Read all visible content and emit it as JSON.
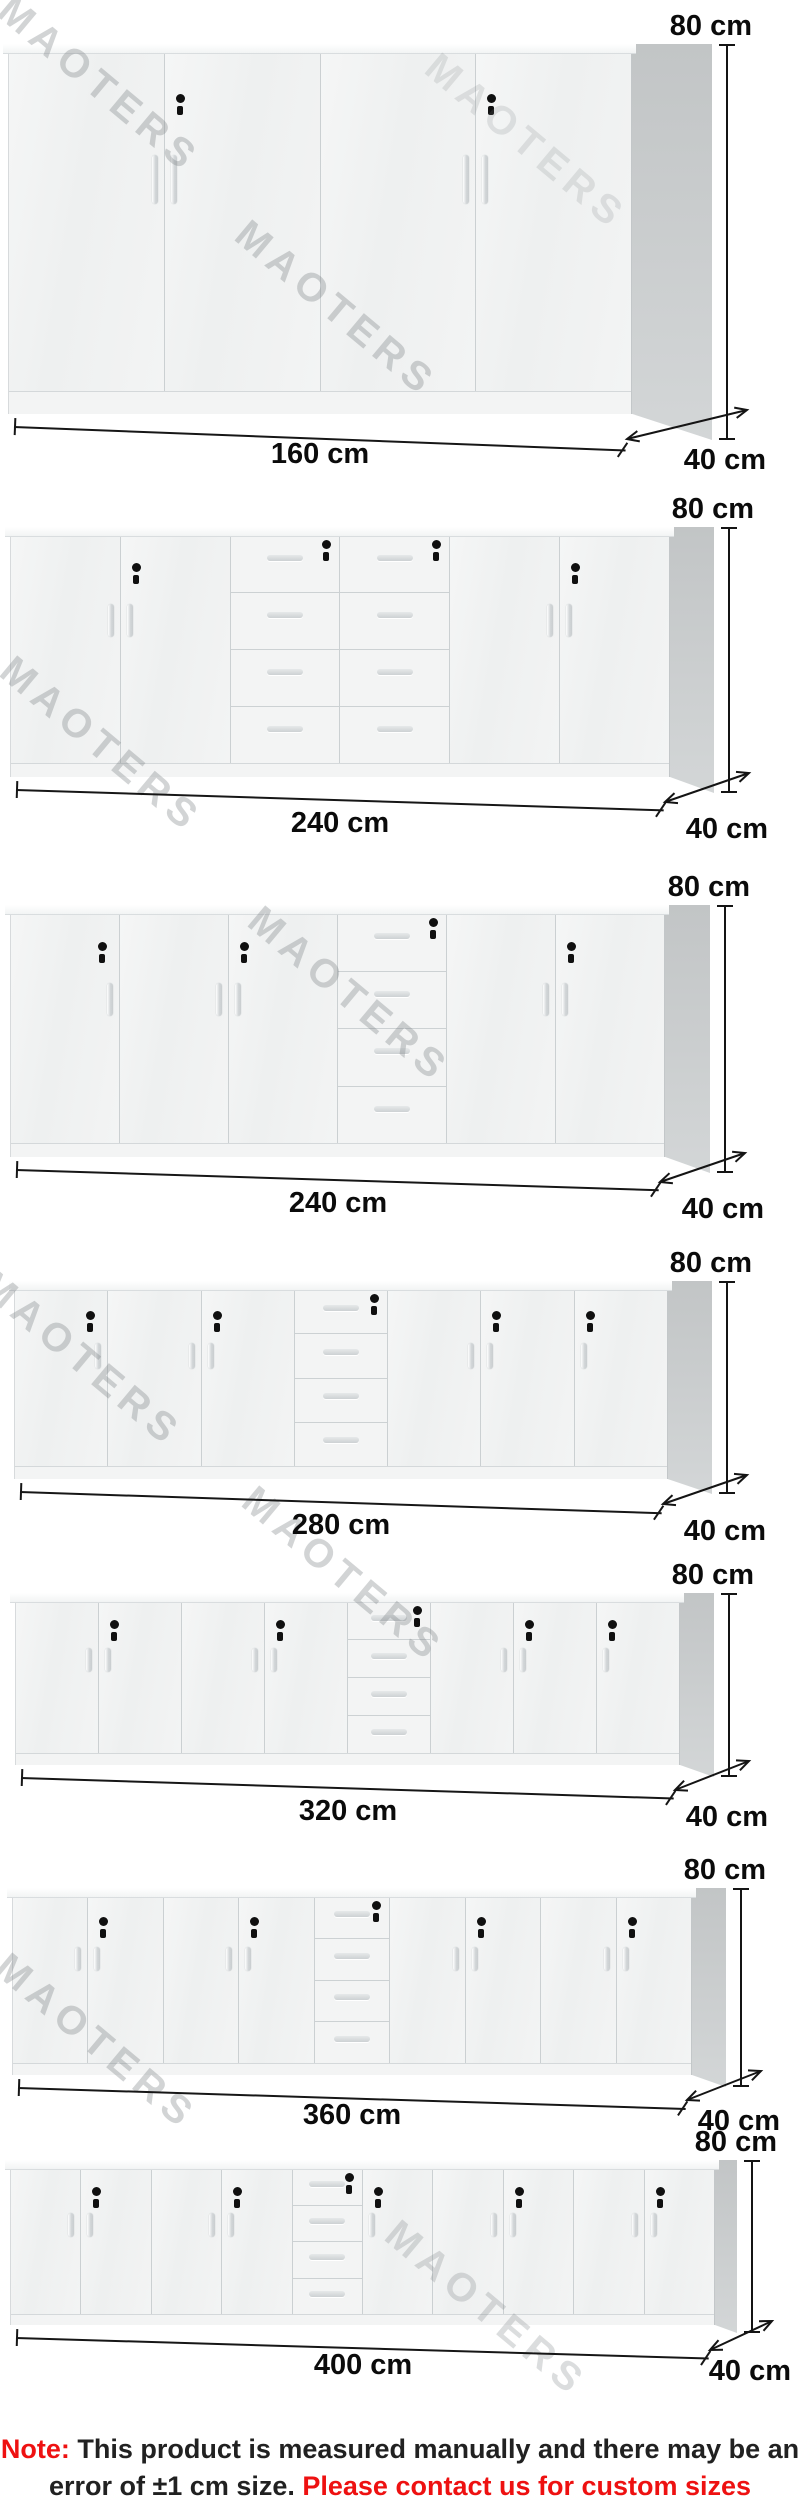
{
  "watermark": {
    "text": "MAOTERS"
  },
  "colors": {
    "accent_red": "#ee1111",
    "cabinet_side_gray": "#c8cbcc",
    "dimension_text": "#0b0b0b",
    "watermark_gray": "#c9c9c9"
  },
  "cabinets": [
    {
      "width_label": "160 cm",
      "height_label": "80 cm",
      "depth_label": "40 cm",
      "columns": [
        {
          "type": "door",
          "handle": "right"
        },
        {
          "type": "door",
          "handle": "left",
          "lock": true
        },
        {
          "type": "door",
          "handle": "right"
        },
        {
          "type": "door",
          "handle": "left",
          "lock": true
        }
      ]
    },
    {
      "width_label": "240 cm",
      "height_label": "80 cm",
      "depth_label": "40 cm",
      "columns": [
        {
          "type": "door",
          "handle": "right"
        },
        {
          "type": "door",
          "handle": "left",
          "lock": true
        },
        {
          "type": "drawers",
          "drawer_count": 4,
          "lock": true
        },
        {
          "type": "drawers",
          "drawer_count": 4,
          "lock": true
        },
        {
          "type": "door",
          "handle": "right"
        },
        {
          "type": "door",
          "handle": "left",
          "lock": true
        }
      ]
    },
    {
      "width_label": "240 cm",
      "height_label": "80 cm",
      "depth_label": "40 cm",
      "columns": [
        {
          "type": "door",
          "handle": "right",
          "lock": true
        },
        {
          "type": "door",
          "handle": "right"
        },
        {
          "type": "door",
          "handle": "left",
          "lock": true
        },
        {
          "type": "drawers",
          "drawer_count": 4,
          "lock": true
        },
        {
          "type": "door",
          "handle": "right"
        },
        {
          "type": "door",
          "handle": "left",
          "lock": true
        }
      ]
    },
    {
      "width_label": "280 cm",
      "height_label": "80 cm",
      "depth_label": "40 cm",
      "columns": [
        {
          "type": "door",
          "handle": "right",
          "lock": true
        },
        {
          "type": "door",
          "handle": "right"
        },
        {
          "type": "door",
          "handle": "left",
          "lock": true
        },
        {
          "type": "drawers",
          "drawer_count": 4,
          "lock": true
        },
        {
          "type": "door",
          "handle": "right"
        },
        {
          "type": "door",
          "handle": "left",
          "lock": true
        },
        {
          "type": "door",
          "handle": "left",
          "lock": true
        }
      ]
    },
    {
      "width_label": "320 cm",
      "height_label": "80 cm",
      "depth_label": "40 cm",
      "columns": [
        {
          "type": "door",
          "handle": "right"
        },
        {
          "type": "door",
          "handle": "left",
          "lock": true
        },
        {
          "type": "door",
          "handle": "right"
        },
        {
          "type": "door",
          "handle": "left",
          "lock": true
        },
        {
          "type": "drawers",
          "drawer_count": 4,
          "lock": true
        },
        {
          "type": "door",
          "handle": "right"
        },
        {
          "type": "door",
          "handle": "left",
          "lock": true
        },
        {
          "type": "door",
          "handle": "left",
          "lock": true
        }
      ]
    },
    {
      "width_label": "360 cm",
      "height_label": "80 cm",
      "depth_label": "40 cm",
      "columns": [
        {
          "type": "door",
          "handle": "right"
        },
        {
          "type": "door",
          "handle": "left",
          "lock": true
        },
        {
          "type": "door",
          "handle": "right"
        },
        {
          "type": "door",
          "handle": "left",
          "lock": true
        },
        {
          "type": "drawers",
          "drawer_count": 4,
          "lock": true
        },
        {
          "type": "door",
          "handle": "right"
        },
        {
          "type": "door",
          "handle": "left",
          "lock": true
        },
        {
          "type": "door",
          "handle": "right"
        },
        {
          "type": "door",
          "handle": "left",
          "lock": true
        }
      ]
    },
    {
      "width_label": "400 cm",
      "height_label": "80 cm",
      "depth_label": "40 cm",
      "columns": [
        {
          "type": "door",
          "handle": "right"
        },
        {
          "type": "door",
          "handle": "left",
          "lock": true
        },
        {
          "type": "door",
          "handle": "right"
        },
        {
          "type": "door",
          "handle": "left",
          "lock": true
        },
        {
          "type": "drawers",
          "drawer_count": 4,
          "lock": true
        },
        {
          "type": "door",
          "handle": "left",
          "lock": true
        },
        {
          "type": "door",
          "handle": "right"
        },
        {
          "type": "door",
          "handle": "left",
          "lock": true
        },
        {
          "type": "door",
          "handle": "right"
        },
        {
          "type": "door",
          "handle": "left",
          "lock": true
        }
      ]
    }
  ],
  "note": {
    "label": "Note:",
    "line1": " This product is measured manually and there may be an",
    "line2_black": "error of ±1 cm size. ",
    "line2_red": "Please contact us for custom sizes"
  }
}
